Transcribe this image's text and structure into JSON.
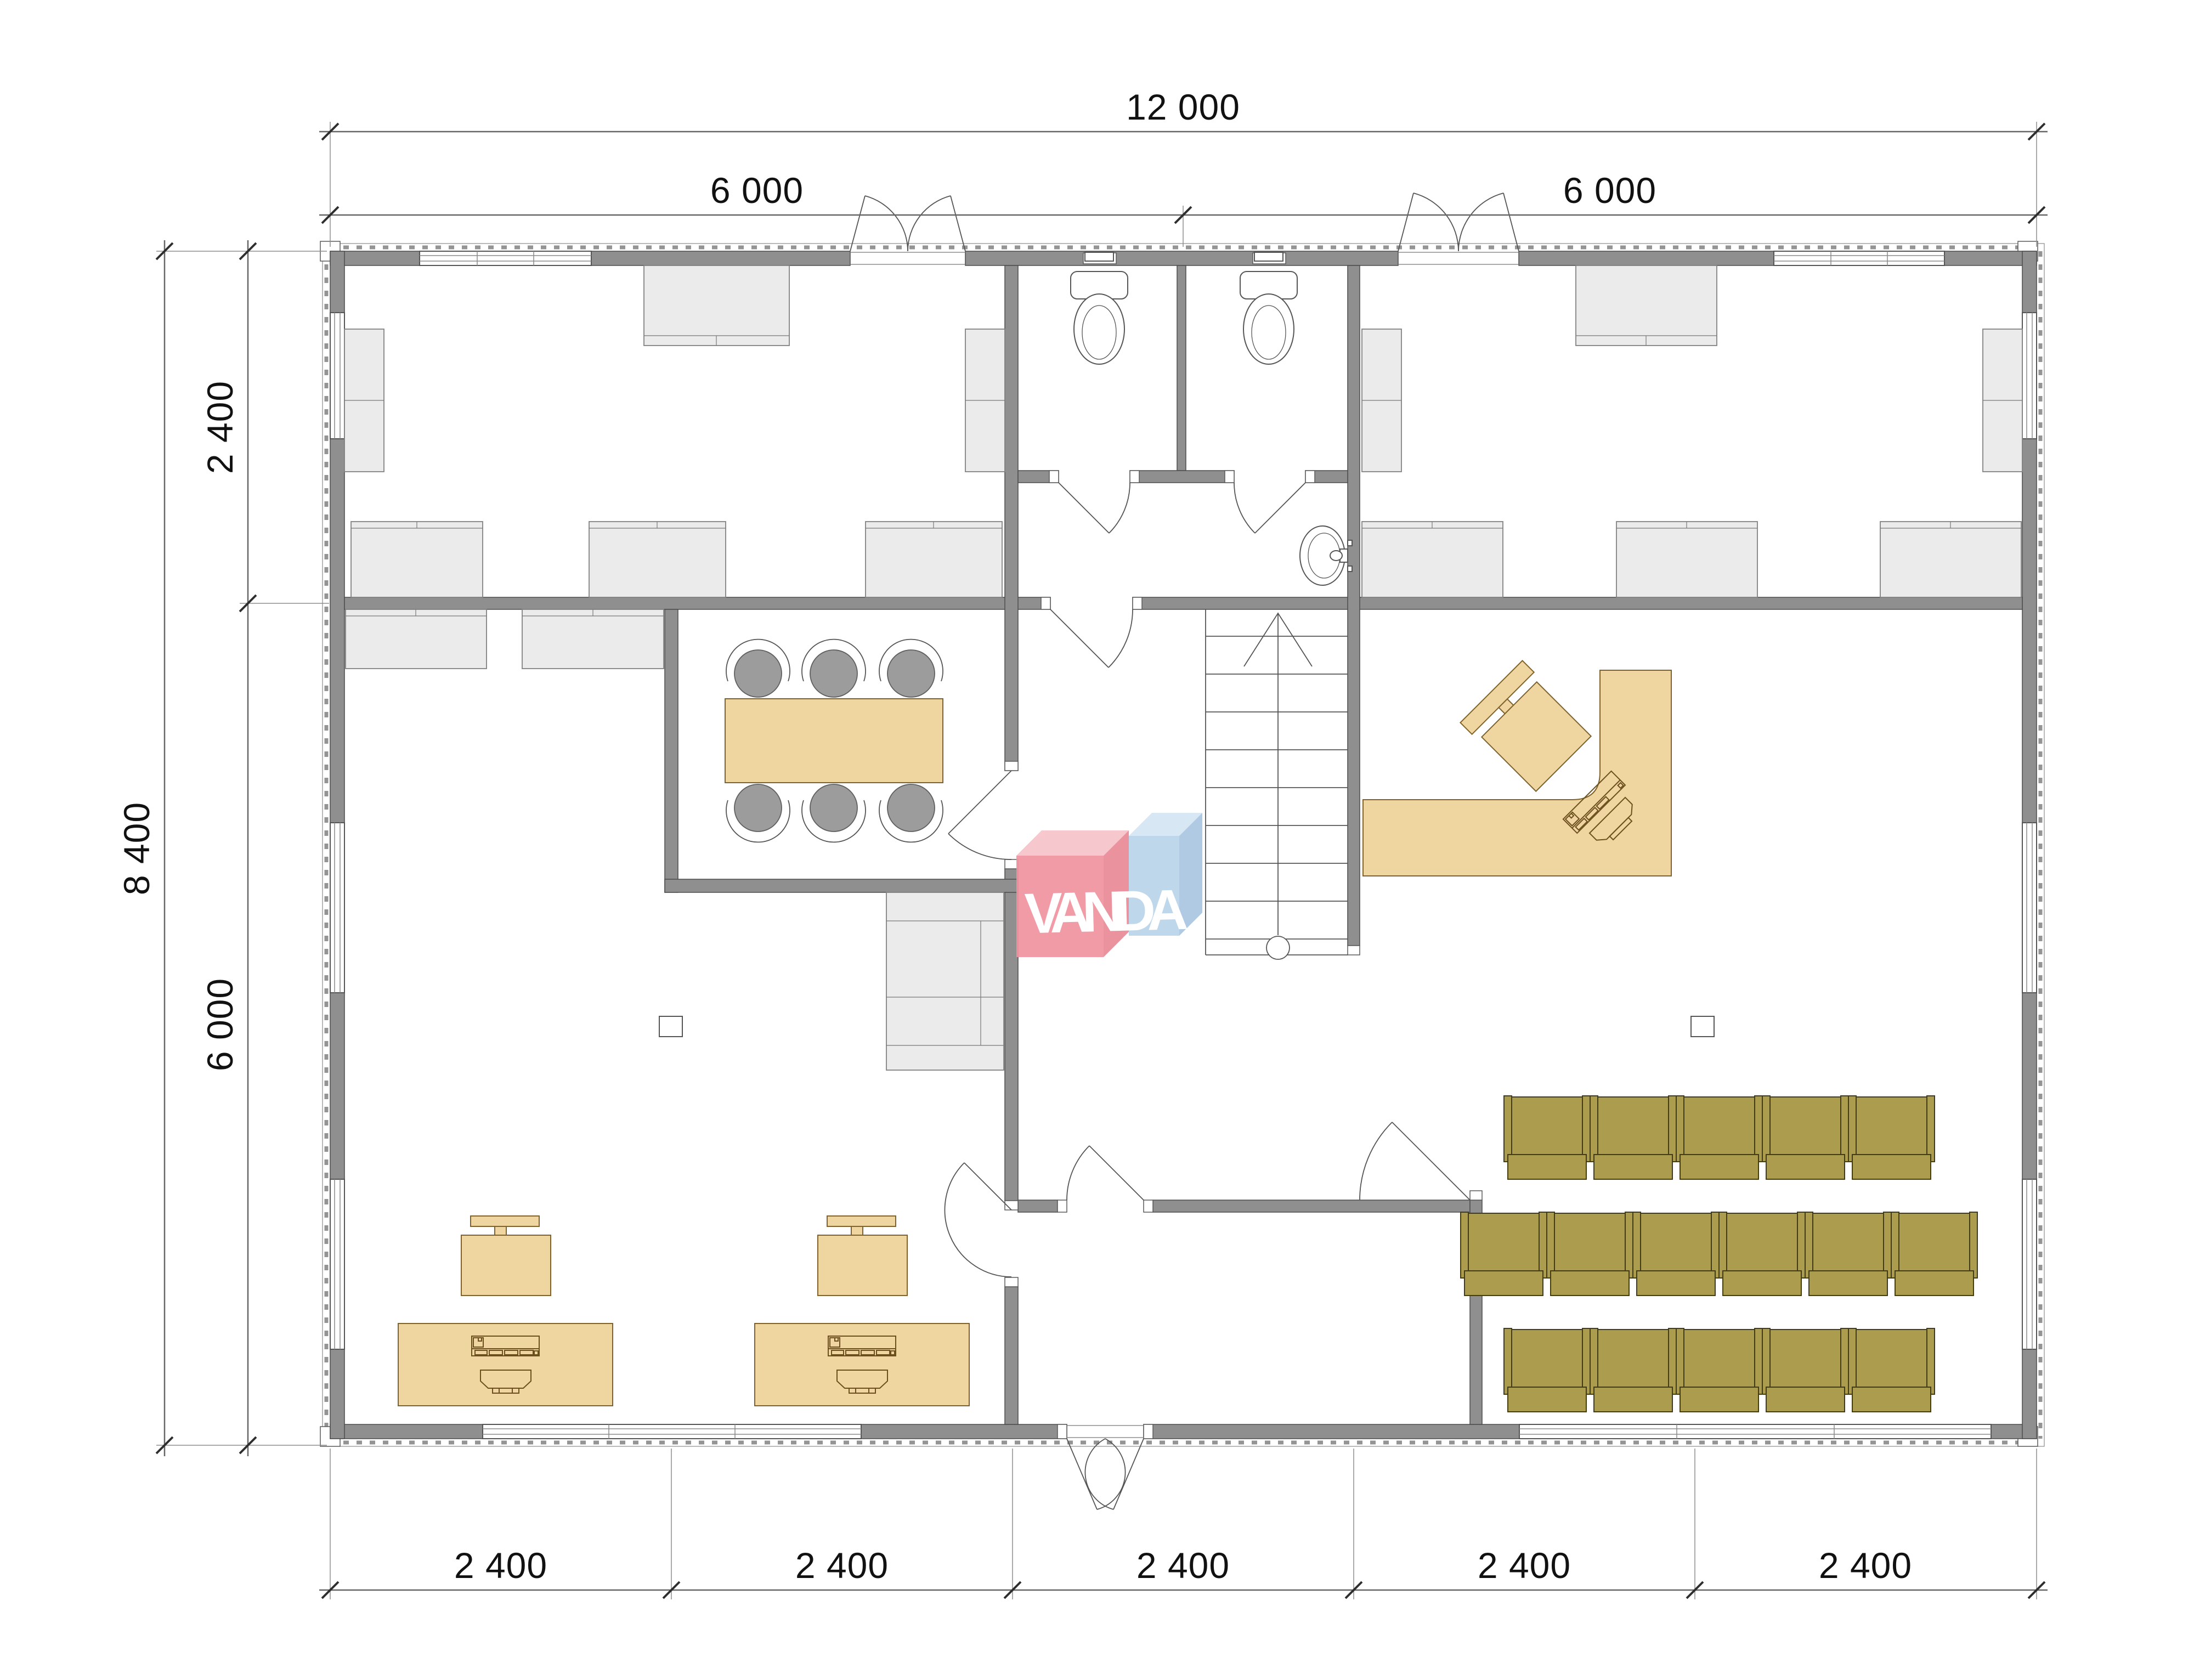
{
  "plan": {
    "watermark": "VANDA",
    "dimensions": {
      "top_total": "12 000",
      "top_left_half": "6 000",
      "top_right_half": "6 000",
      "side_total": "8 400",
      "side_top": "2 400",
      "side_bottom": "6 000",
      "bottom_segments": [
        "2 400",
        "2 400",
        "2 400",
        "2 400",
        "2 400"
      ]
    },
    "colors": {
      "wall": "#8f8f8f",
      "furniture_gray": "#ebebeb",
      "wood": "#efd6a0",
      "chair_olive": "#ab9c4e",
      "logo_red": "#f0939f",
      "logo_red_top": "#f7c3ca",
      "logo_blue": "#bad4ea",
      "logo_blue_top": "#d5e6f4",
      "outline": "#4d4d4d"
    },
    "icons": [
      "toilet-icon",
      "sink-icon",
      "stairs-icon",
      "door-swing-icon",
      "desk-icon",
      "office-chair-icon",
      "meeting-table-icon",
      "audience-chair-icon",
      "reception-desk-icon",
      "cabinet-icon",
      "window-icon"
    ]
  }
}
